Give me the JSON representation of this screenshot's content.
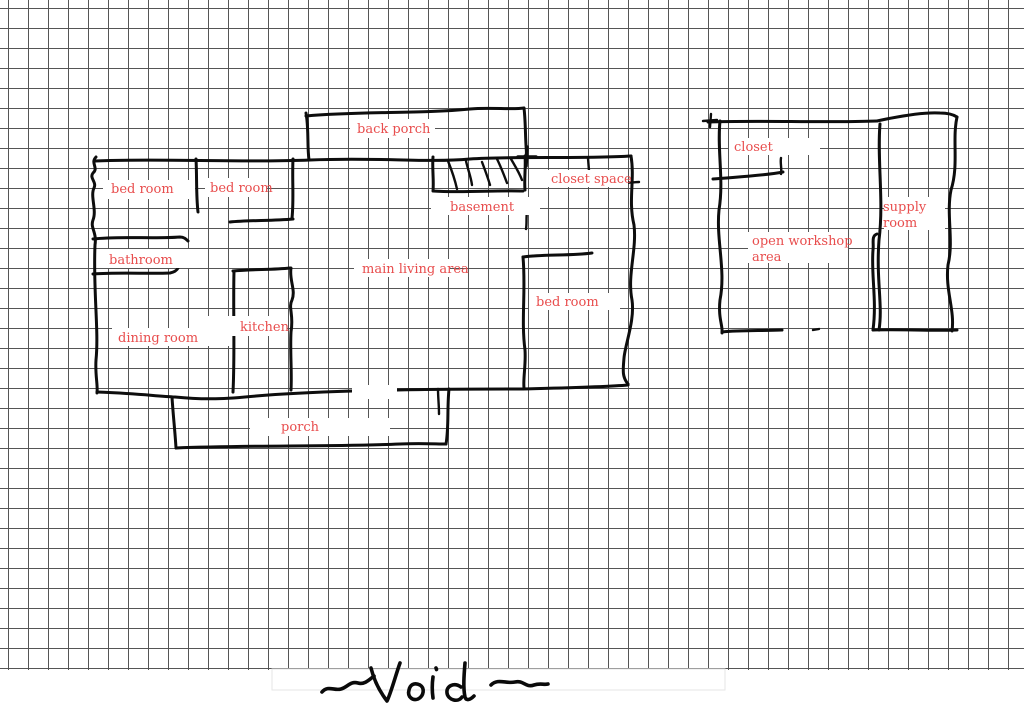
{
  "canvas": {
    "kind": "hand-drawn floor plan sketch on graph paper",
    "width": 1024,
    "height": 726
  },
  "palette": {
    "paper": "#ffffff",
    "grid_line": "#555555",
    "ink": "#0d0d0d",
    "label_text": "#e84d4d",
    "footer_box_border": "#e6e6e6"
  },
  "rooms": {
    "back_porch": {
      "label": "back porch"
    },
    "bed_room_1": {
      "label": "bed room"
    },
    "bed_room_2": {
      "label": "bed room"
    },
    "closet_space": {
      "label": "closet space"
    },
    "basement": {
      "label": "basement"
    },
    "bathroom": {
      "label": "bathroom"
    },
    "main_living_area": {
      "label": "main living area"
    },
    "bed_room_3": {
      "label": "bed room"
    },
    "dining_room": {
      "label": "dining room"
    },
    "kitchen": {
      "label": "kitchen"
    },
    "porch": {
      "label": "porch"
    },
    "closet": {
      "label": "closet"
    },
    "open_workshop": {
      "line1": "open workshop",
      "line2": "area"
    },
    "supply_room": {
      "line1": "supply",
      "line2": "room"
    }
  },
  "signature": {
    "text": "Void"
  }
}
